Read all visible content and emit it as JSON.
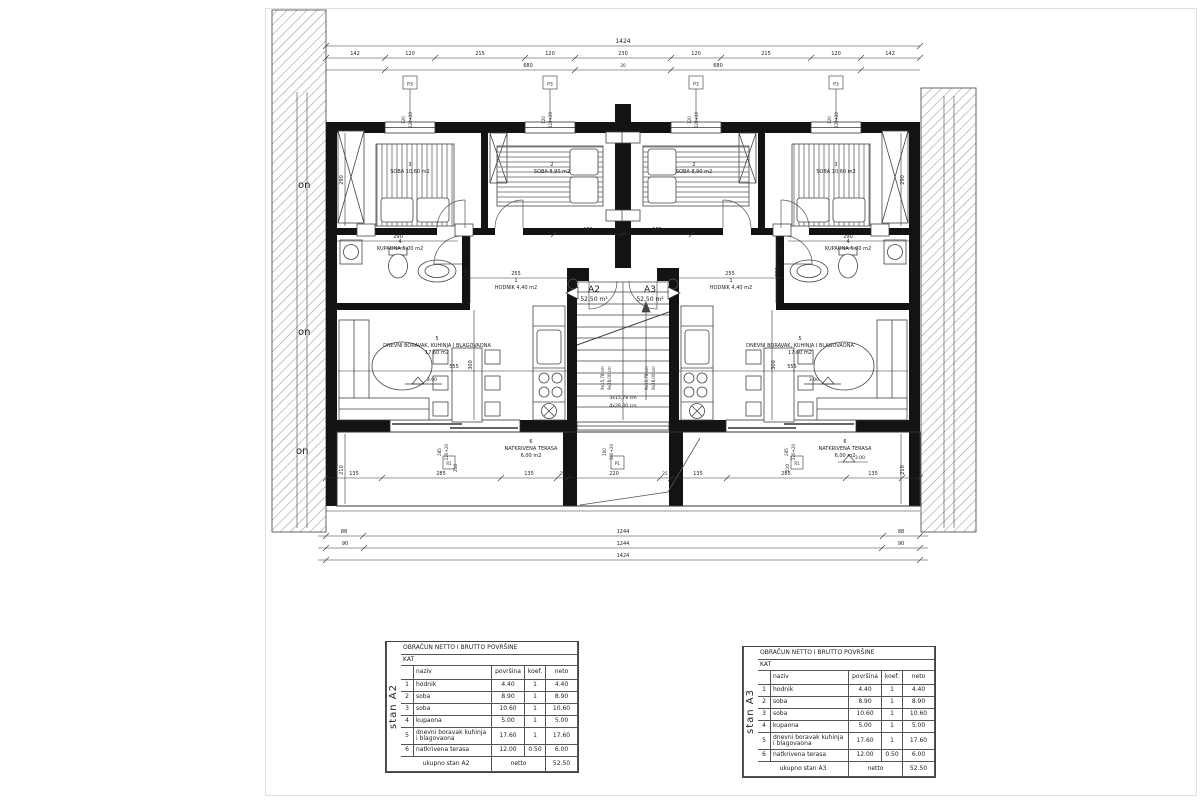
{
  "plan": {
    "apartments": {
      "a2_id": "A2",
      "a2_area": "52,50 m²",
      "a3_id": "A3",
      "a3_area": "52,50 m²"
    },
    "rooms": {
      "soba_big": {
        "num": "3",
        "name": "SOBA 10,60 m2"
      },
      "soba_small": {
        "num": "2",
        "name": "SOBA 8,90 m2"
      },
      "kupaona": {
        "num": "4",
        "name": "KUPAONA 5,00 m2"
      },
      "hodnik": {
        "num": "1",
        "name": "HODNIK 4,40 m2"
      },
      "dnevni": {
        "num": "5",
        "name": "DNEVNI BORAVAK, KUHINJA I BLAGOVAONA",
        "area": "17,60 m2"
      },
      "terasa": {
        "num": "6",
        "name": "NATKRIVENA TERASA",
        "area": "6,00 m2"
      }
    },
    "stairs": {
      "run_a": "3x15,78 cm",
      "run_b": "4x28,00 cm",
      "flight_a": "9x15,78 cm",
      "flight_b": "9x28,00 cm"
    },
    "levels": {
      "floor": "3.00"
    },
    "watermark": "on"
  },
  "labels": {
    "p3": "P3",
    "p1": "P1",
    "r1": "R1"
  },
  "dims": {
    "overall": "1424",
    "top_segments": [
      "142",
      "120",
      "215",
      "120",
      "230",
      "120",
      "215",
      "120",
      "142"
    ],
    "sub_left": "680",
    "sub_mid": "20",
    "sub_right": "680",
    "bottom_small_a": "88",
    "bottom_small_b": "90",
    "bottom_main": "1244",
    "bottom_overall": "1424",
    "terrace": [
      "135",
      "285",
      "135",
      "25",
      "220",
      "25",
      "135",
      "285",
      "135"
    ],
    "bay": "165",
    "hall_w": "255",
    "hall_h": "220",
    "bath_w": "290",
    "room_h": "290",
    "living_w": "555",
    "living_h": "300",
    "terrace_h": "210",
    "door_w": "110",
    "stair_wall": "25",
    "win_w": "120",
    "win_h": "120+20",
    "door_big_a": "285",
    "door_big_b": "220+20",
    "cwin_a": "100",
    "cwin_b": "100+20"
  },
  "tables": [
    {
      "side_label": "stan A2",
      "title": "OBRAČUN NETTO I BRUTTO POVRŠINE",
      "floor": "KAT",
      "headers": {
        "naziv": "naziv",
        "povrsina": "površina",
        "koef": "koef.",
        "neto": "neto"
      },
      "rows": [
        [
          "1",
          "hodnik",
          "4.40",
          "1",
          "4.40"
        ],
        [
          "2",
          "soba",
          "8.90",
          "1",
          "8.90"
        ],
        [
          "3",
          "soba",
          "10.60",
          "1",
          "10.60"
        ],
        [
          "4",
          "kupaona",
          "5.00",
          "1",
          "5.00"
        ],
        [
          "5",
          "dnevni boravak kuhinja i blagovaona",
          "17.60",
          "1",
          "17.60"
        ],
        [
          "6",
          "natkrivena terasa",
          "12.00",
          "0.50",
          "6.00"
        ]
      ],
      "footer": {
        "label": "ukupno stan A2",
        "mid": "netto",
        "value": "52.50"
      }
    },
    {
      "side_label": "stan A3",
      "title": "OBRAČUN NETTO I BRUTTO POVRŠINE",
      "floor": "KAT",
      "headers": {
        "naziv": "naziv",
        "povrsina": "površina",
        "koef": "koef.",
        "neto": "neto"
      },
      "rows": [
        [
          "1",
          "hodnik",
          "4.40",
          "1",
          "4.40"
        ],
        [
          "2",
          "soba",
          "8.90",
          "1",
          "8.90"
        ],
        [
          "3",
          "soba",
          "10.60",
          "1",
          "10.60"
        ],
        [
          "4",
          "kupaona",
          "5.00",
          "1",
          "5.00"
        ],
        [
          "5",
          "dnevni boravak kuhinja i blagovaona",
          "17.60",
          "1",
          "17.60"
        ],
        [
          "6",
          "natkrivena terasa",
          "12.00",
          "0.50",
          "6.00"
        ]
      ],
      "footer": {
        "label": "ukupno stan A3",
        "mid": "netto",
        "value": "52.50"
      }
    }
  ]
}
